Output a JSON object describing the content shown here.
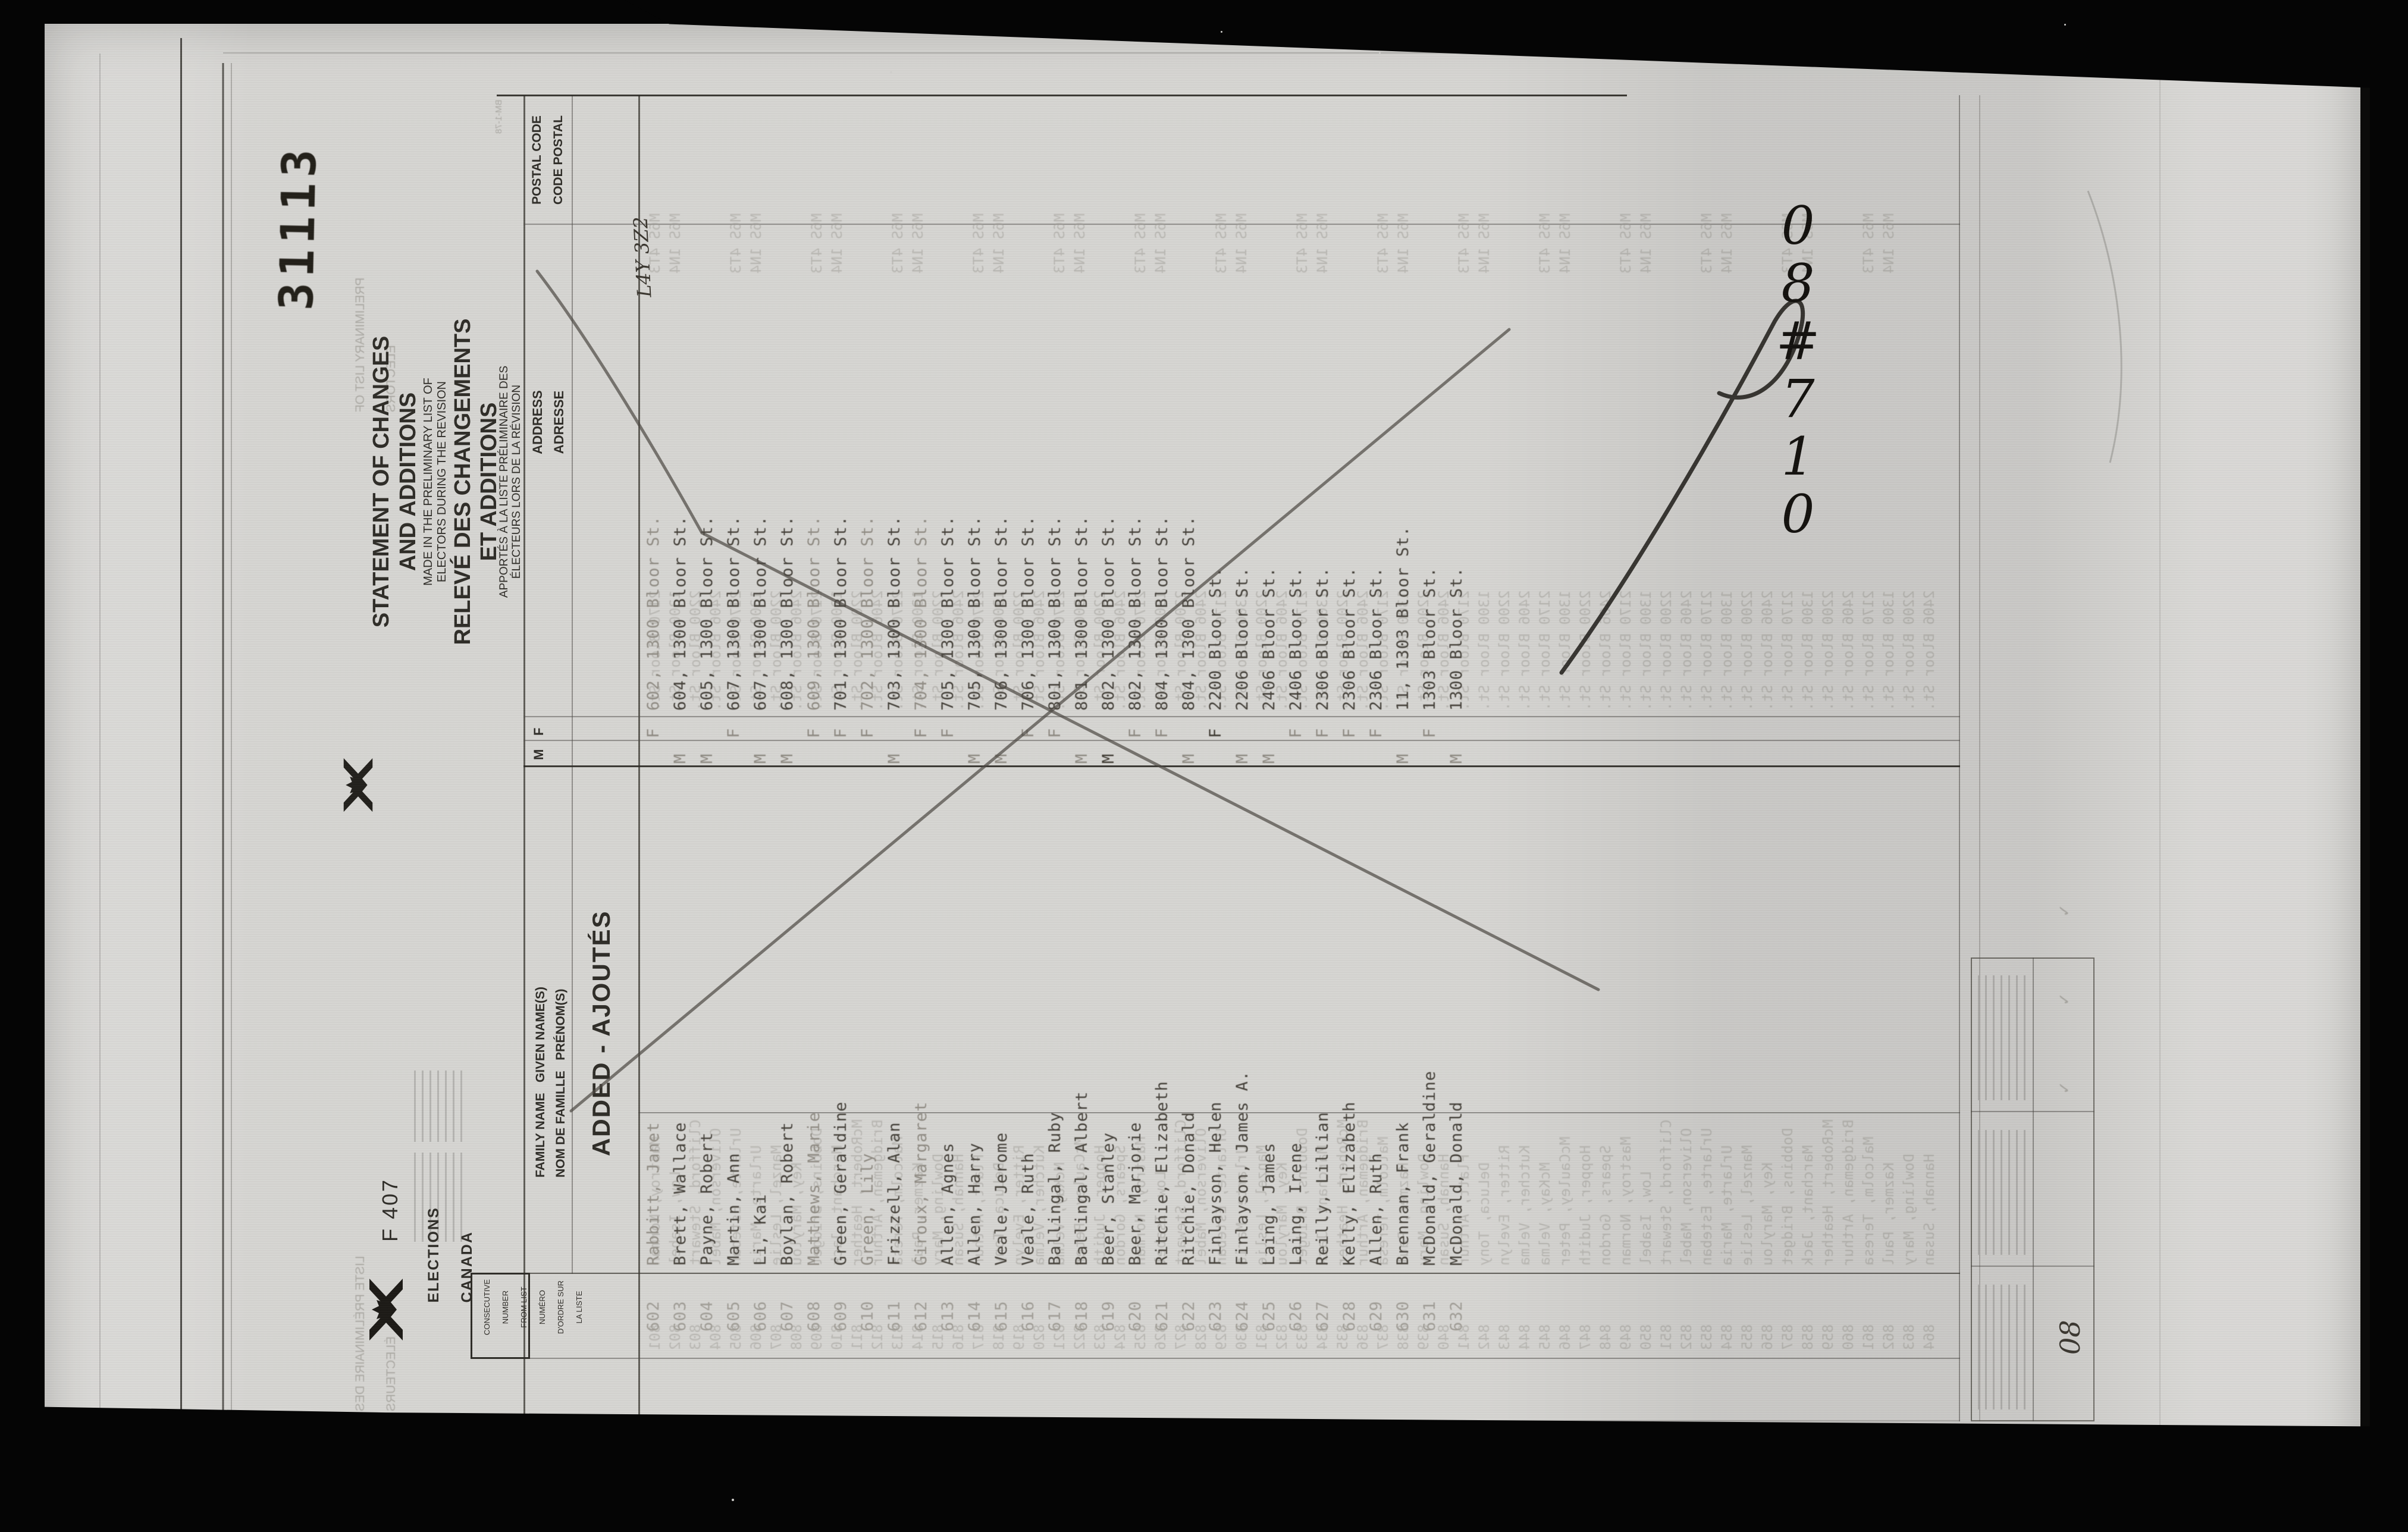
{
  "film": {
    "stamp": "31113",
    "handwritten_note": "08#710"
  },
  "form": {
    "form_number": "F 407",
    "logo": {
      "icon": "elections-canada-flag-logo",
      "wordmark_line1": "ELECTIONS",
      "wordmark_line2": "CANADA"
    },
    "title": {
      "en_line1": "STATEMENT OF CHANGES",
      "en_line2": "AND ADDITIONS",
      "en_sub1": "MADE IN THE PRELIMINARY LIST OF",
      "en_sub2": "ELECTORS DURING THE REVISION",
      "fr_line1": "RELEVÉ DES CHANGEMENTS",
      "fr_line2": "ET ADDITIONS",
      "fr_sub1": "APPORTÉS À LA LISTE PRÉLIMINAIRE DES",
      "fr_sub2": "ÉLECTEURS LORS DE LA RÉVISION"
    },
    "section_label": "ADDED - AJOUTÉS",
    "headers": {
      "number_lines": [
        "CONSECUTIVE",
        "NUMBER",
        "FROM LIST",
        "NUMÉRO",
        "D'ORDRE SUR",
        "LA LISTE"
      ],
      "name_en": "FAMILY NAME   GIVEN NAME(S)",
      "name_fr": "NOM DE FAMILLE   PRÉNOM(S)",
      "sex_m": "M",
      "sex_f": "F",
      "address_en": "ADDRESS",
      "address_fr": "ADRESSE",
      "postal_en": "POSTAL CODE",
      "postal_fr": "CODE POSTAL"
    },
    "handwritten_postal": "L4Y 3Z2",
    "footer_value": "08",
    "rows": [
      {
        "number": "602",
        "name": "Rabbitt, Janet",
        "sex": "F",
        "address": "602, 1300 Bloor St.",
        "postal": "",
        "tone": "light"
      },
      {
        "number": "603",
        "name": "Brett, Wallace",
        "sex": "M",
        "address": "604, 1300 Bloor St.",
        "postal": "",
        "tone": "dark"
      },
      {
        "number": "604",
        "name": "Payne, Robert",
        "sex": "M",
        "address": "605, 1300 Bloor St.",
        "postal": "",
        "tone": "dark"
      },
      {
        "number": "605",
        "name": "Martin, Ann",
        "sex": "F",
        "address": "607, 1300 Bloor St.",
        "postal": "",
        "tone": "dark"
      },
      {
        "number": "606",
        "name": "Li, Kai",
        "sex": "M",
        "address": "607, 1300 Bloor St.",
        "postal": "",
        "tone": "dark"
      },
      {
        "number": "607",
        "name": "Boylan, Robert",
        "sex": "M",
        "address": "608, 1300 Bloor St.",
        "postal": "",
        "tone": "dark"
      },
      {
        "number": "608",
        "name": "Matthews, Marie",
        "sex": "F",
        "address": "609, 1300 Bloor St.",
        "postal": "",
        "tone": "light"
      },
      {
        "number": "609",
        "name": "Green, Geraldine",
        "sex": "F",
        "address": "701, 1300 Bloor St.",
        "postal": "",
        "tone": "dark"
      },
      {
        "number": "610",
        "name": "Green, Lily",
        "sex": "F",
        "address": "702, 1300 Bloor St.",
        "postal": "",
        "tone": "light"
      },
      {
        "number": "611",
        "name": "Frizzell, Alan",
        "sex": "M",
        "address": "703, 1300 Bloor St.",
        "postal": "",
        "tone": "dark"
      },
      {
        "number": "612",
        "name": "Giroux, Margaret",
        "sex": "F",
        "address": "704, 1300 Bloor St.",
        "postal": "",
        "tone": "light"
      },
      {
        "number": "613",
        "name": "Allen, Agnes",
        "sex": "F",
        "address": "705, 1300 Bloor St.",
        "postal": "",
        "tone": "dark"
      },
      {
        "number": "614",
        "name": "Allen, Harry",
        "sex": "M",
        "address": "705, 1300 Bloor St.",
        "postal": "",
        "tone": "dark"
      },
      {
        "number": "615",
        "name": "Veale, Jerome",
        "sex": "M",
        "address": "706, 1300 Bloor St.",
        "postal": "",
        "tone": "dark"
      },
      {
        "number": "616",
        "name": "Veale, Ruth",
        "sex": "F",
        "address": "706, 1300 Bloor St.",
        "postal": "",
        "tone": "dark"
      },
      {
        "number": "617",
        "name": "Ballingal, Ruby",
        "sex": "F",
        "address": "801, 1300 Bloor St.",
        "postal": "",
        "tone": "dark"
      },
      {
        "number": "618",
        "name": "Ballingal, Albert",
        "sex": "M",
        "address": "801, 1300 Bloor St.",
        "postal": "",
        "tone": "dark"
      },
      {
        "number": "619",
        "name": "Beer, Stanley",
        "sex": "M",
        "address": "802, 1300 Bloor St.",
        "postal": "",
        "tone": "dark",
        "mark": true
      },
      {
        "number": "620",
        "name": "Beer, Marjorie",
        "sex": "F",
        "address": "802, 1300 Bloor St.",
        "postal": "",
        "tone": "dark"
      },
      {
        "number": "621",
        "name": "Ritchie, Elizabeth",
        "sex": "F",
        "address": "804, 1300 Bloor St.",
        "postal": "",
        "tone": "dark"
      },
      {
        "number": "622",
        "name": "Ritchie, Donald",
        "sex": "M",
        "address": "804, 1300 Bloor St.",
        "postal": "",
        "tone": "dark"
      },
      {
        "number": "623",
        "name": "Finlayson, Helen",
        "sex": "F",
        "address": "2200 Bloor St.",
        "postal": "",
        "tone": "dark",
        "mark": true
      },
      {
        "number": "624",
        "name": "Finlayson, James A.",
        "sex": "M",
        "address": "2206 Bloor St.",
        "postal": "",
        "tone": "dark"
      },
      {
        "number": "625",
        "name": "Laing, James",
        "sex": "M",
        "address": "2406 Bloor St.",
        "postal": "",
        "tone": "dark"
      },
      {
        "number": "626",
        "name": "Laing, Irene",
        "sex": "F",
        "address": "2406 Bloor St.",
        "postal": "",
        "tone": "dark"
      },
      {
        "number": "627",
        "name": "Reilly, Lillian",
        "sex": "F",
        "address": "2306 Bloor St.",
        "postal": "",
        "tone": "dark"
      },
      {
        "number": "628",
        "name": "Kelly, Elizabeth",
        "sex": "F",
        "address": "2306 Bloor St.",
        "postal": "",
        "tone": "dark"
      },
      {
        "number": "629",
        "name": "Allen, Ruth",
        "sex": "F",
        "address": "2306 Bloor St.",
        "postal": "",
        "tone": "dark"
      },
      {
        "number": "630",
        "name": "Brennan, Frank",
        "sex": "M",
        "address": "11, 1303 Bloor St.",
        "postal": "",
        "tone": "dark"
      },
      {
        "number": "631",
        "name": "McDonald, Geraldine",
        "sex": "F",
        "address": "1303 Bloor St.",
        "postal": "",
        "tone": "dark"
      },
      {
        "number": "632",
        "name": "McDonald, Donald",
        "sex": "M",
        "address": "1300 Bloor St.",
        "postal": "",
        "tone": "dark"
      }
    ],
    "bleed": {
      "form_code": "BM-1-78",
      "header_en": [
        "PRELIMINARY LIST OF",
        "ELECTORS"
      ],
      "header_fr": [
        "LISTE PRÉLIMINAIRE DES",
        "ÉLECTEURS"
      ],
      "names": [
        "Mastroy, Norman",
        "Low, Isabel",
        "Clifford, Stewart",
        "Oliverson, Mabel",
        "Urlarte, Esteban",
        "Urlarte, Maria",
        "Manzel, Leslie",
        "Key, Marylou",
        "Dobbins, Bridget",
        "Marchant, Jack",
        "McRobert, Heather",
        "Bridgeman, Arthur",
        "Malcolm, Teresa",
        "Kazmer, Paul",
        "Dowling, Mary",
        "Hannah, Susan",
        "Flatt, Arthur",
        "DeLuca, Tony",
        "Ritter, Evelyn",
        "Kutcher, Velma",
        "McKay, Velma",
        "McCauley, Peter",
        "Hopper, Judith",
        "Spears, Gordon"
      ],
      "addresses": [
        "2170 Bloor St.",
        "1300 Bloor St.",
        "2200 Bloor St.",
        "2406 Bloor St."
      ],
      "postals": [
        "M6S 4T3",
        "M6S 1N4",
        "",
        ""
      ],
      "start_number": 801,
      "row_count": 64
    }
  },
  "colors": {
    "paper": "#d6d5d2",
    "ink": "#2f2d28",
    "typewriter": "#45413a",
    "faint": "#a3a19b",
    "film_black": "#050505"
  }
}
